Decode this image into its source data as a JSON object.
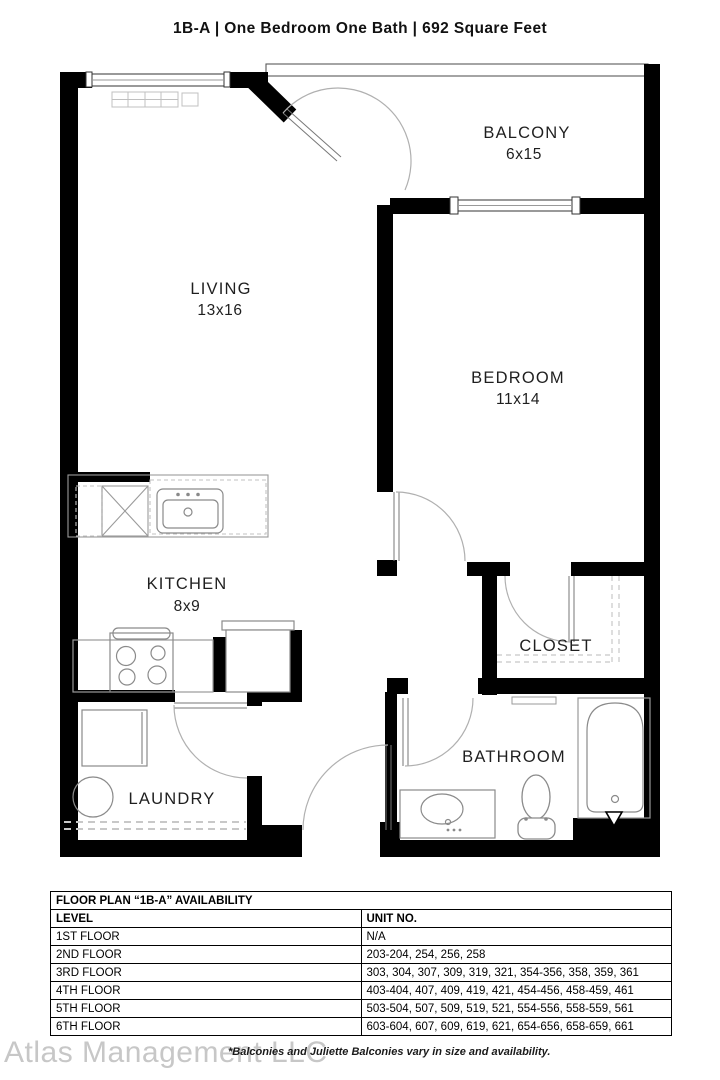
{
  "title": "1B-A  |  One Bedroom One Bath  |  692 Square Feet",
  "floor_plan": {
    "rooms": {
      "living": {
        "name": "LIVING",
        "dims": "13x16"
      },
      "bedroom": {
        "name": "BEDROOM",
        "dims": "11x14"
      },
      "balcony": {
        "name": "BALCONY",
        "dims": "6x15"
      },
      "kitchen": {
        "name": "KITCHEN",
        "dims": "8x9"
      },
      "closet": {
        "name": "CLOSET"
      },
      "bathroom": {
        "name": "BATHROOM"
      },
      "laundry": {
        "name": "LAUNDRY"
      }
    }
  },
  "availability_table": {
    "title": "FLOOR PLAN “1B-A” AVAILABILITY",
    "columns": {
      "level": "LEVEL",
      "unit_no": "UNIT NO."
    },
    "rows": [
      {
        "level": "1ST FLOOR",
        "units": "N/A"
      },
      {
        "level": "2ND FLOOR",
        "units": "203-204, 254, 256, 258"
      },
      {
        "level": "3RD FLOOR",
        "units": "303, 304, 307, 309, 319, 321, 354-356, 358, 359, 361"
      },
      {
        "level": "4TH FLOOR",
        "units": "403-404, 407, 409, 419, 421, 454-456, 458-459, 461"
      },
      {
        "level": "5TH FLOOR",
        "units": "503-504, 507, 509, 519, 521, 554-556, 558-559, 561"
      },
      {
        "level": "6TH FLOOR",
        "units": "603-604, 607, 609, 619, 621, 654-656, 658-659, 661"
      }
    ]
  },
  "footer": {
    "watermark": "Atlas Management LLC",
    "note": "*Balconies and Juliette Balconies vary in size and availability."
  },
  "colors": {
    "wall": "#000000",
    "fixture_line": "#8a8a8a",
    "door_arc": "#b0b0b0",
    "background": "#ffffff"
  }
}
